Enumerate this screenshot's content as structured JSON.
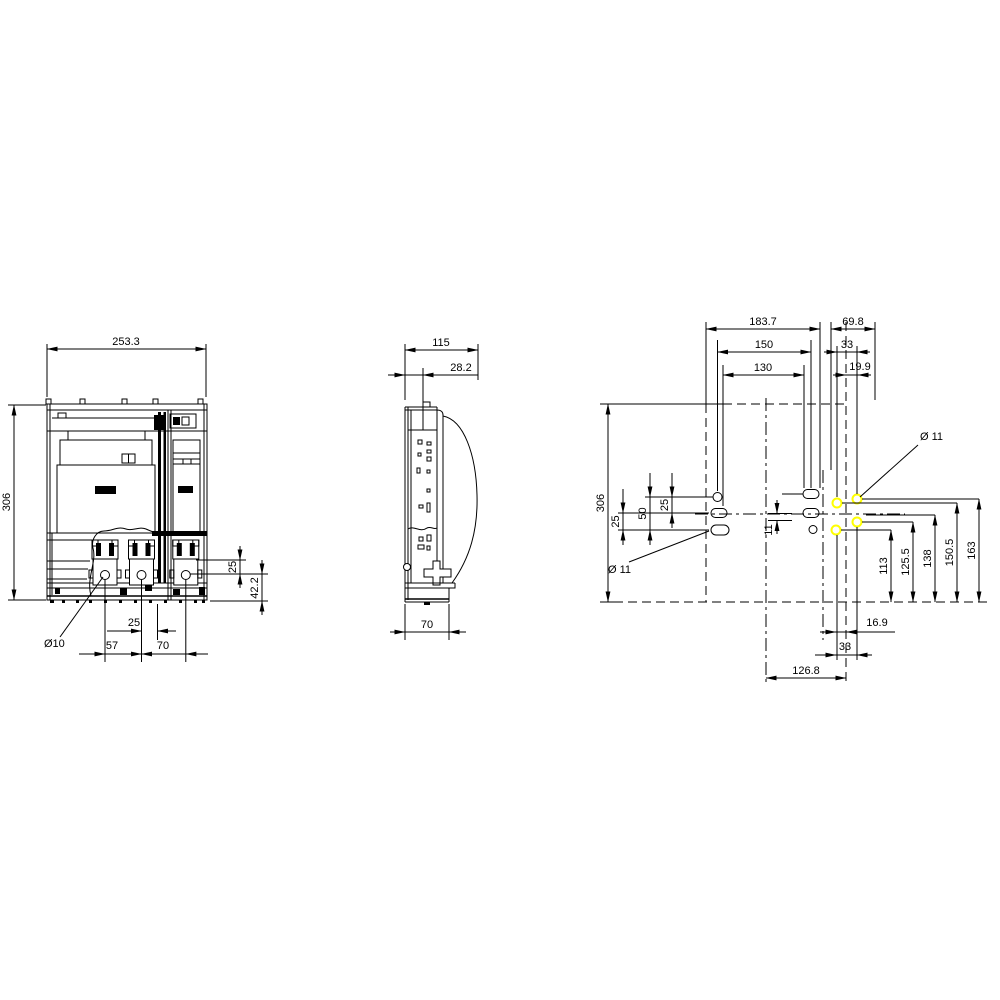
{
  "drawing": {
    "line_color": "#000000",
    "highlight_color": "#ffff00",
    "background_color": "#ffffff"
  },
  "front_view": {
    "overall_width": "253.3",
    "overall_height": "306",
    "hole_top_offset": "25",
    "hole_bottom_offset": "42.2",
    "hole_center_offset": "25",
    "pole_pitch_a": "57",
    "pole_pitch_b": "70",
    "hole_diameter": "Ø10"
  },
  "side_view": {
    "overall_depth": "115",
    "upper_depth": "28.2",
    "base_depth": "70"
  },
  "drill_plan": {
    "overall_height": "306",
    "width_a": "183.7",
    "width_b": "69.8",
    "width_c": "150",
    "width_d": "33",
    "width_e": "130",
    "width_f": "19.9",
    "pitch_lower": "25",
    "pitch_total": "50",
    "pitch_upper": "25",
    "offset_center": "11",
    "height_a": "113",
    "height_b": "125.5",
    "height_c": "138",
    "height_d": "150.5",
    "height_e": "163",
    "bottom_a": "16.9",
    "bottom_b": "33",
    "bottom_c": "126.8",
    "hole_dia_right": "Ø 11",
    "hole_dia_left": "Ø 11"
  }
}
